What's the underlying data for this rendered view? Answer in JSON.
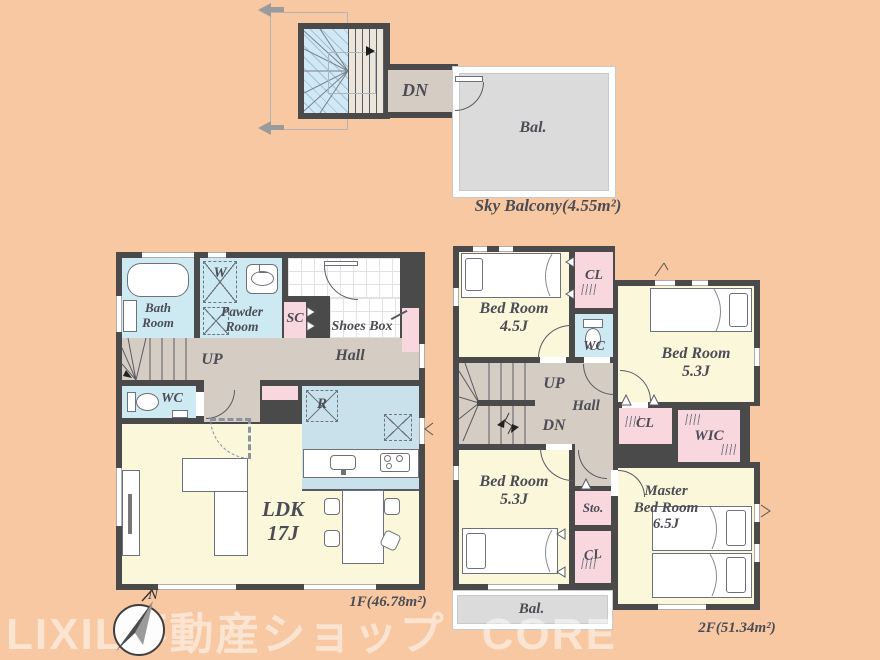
{
  "colors": {
    "background": "#f7c8a2",
    "wall": "#4a4a4a",
    "room_yellow": "#faf7da",
    "room_blue": "#cdeaf3",
    "kitchen_blue": "#c8e1eb",
    "closet_pink": "#f8d8de",
    "hall_beige": "#d5cdc3",
    "balcony_gray": "#dbdbdb",
    "skylight_blue": "#cfe9f6",
    "label_text": "#4c4c55",
    "watermark": "rgba(255,255,255,0.5)"
  },
  "watermark": "LIXIL不動産ショップ CORE",
  "compass": {
    "north": "N"
  },
  "sky": {
    "dn": "DN",
    "balcony": "Bal.",
    "caption": "Sky Balcony(4.55m²)"
  },
  "f1": {
    "caption": "1F(46.78m²)",
    "bath": "Bath\nRoom",
    "washer": "W",
    "powder": "Pawder\nRoom",
    "sc": "SC",
    "shoes_box": "Shoes Box",
    "hall": "Hall",
    "up": "UP",
    "wc": "WC",
    "fridge": "R",
    "ldk": "LDK\n17J"
  },
  "f2": {
    "caption": "2F(51.34m²)",
    "bed_45": "Bed Room\n4.5J",
    "cl_top": "CL",
    "wc": "WC",
    "bed_53_right": "Bed Room\n5.3J",
    "up": "UP",
    "dn": "DN",
    "hall": "Hall",
    "cl_mid": "CL",
    "wic": "WIC",
    "bed_53_left": "Bed Room\n5.3J",
    "sto": "Sto.",
    "master": "Master\nBed Room\n6.5J",
    "cl_bottom": "CL",
    "balcony": "Bal."
  }
}
